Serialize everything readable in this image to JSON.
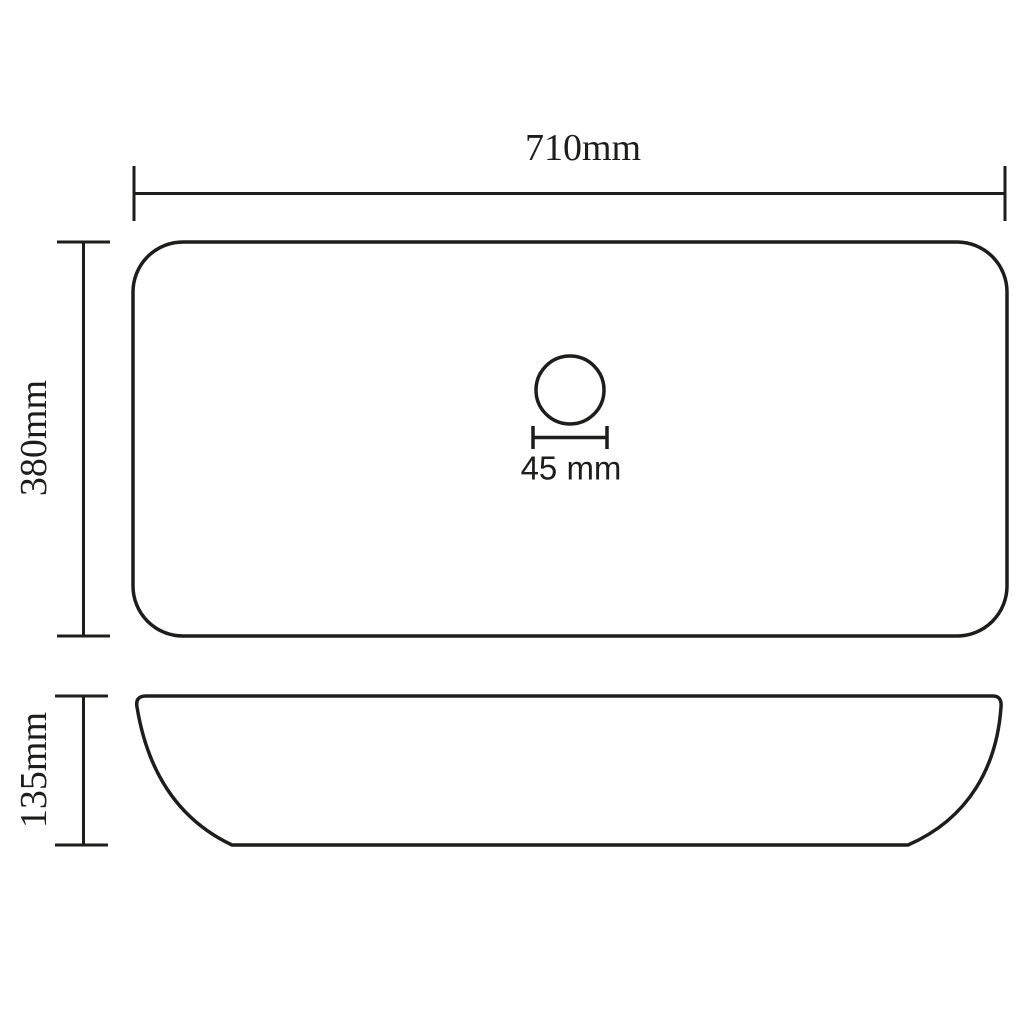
{
  "drawing": {
    "line_color": "#1d1d1b",
    "background_color": "#ffffff",
    "top_view": {
      "width_label": "710mm",
      "depth_label": "380mm",
      "drain_label": "45 mm"
    },
    "side_view": {
      "height_label": "135mm"
    }
  }
}
